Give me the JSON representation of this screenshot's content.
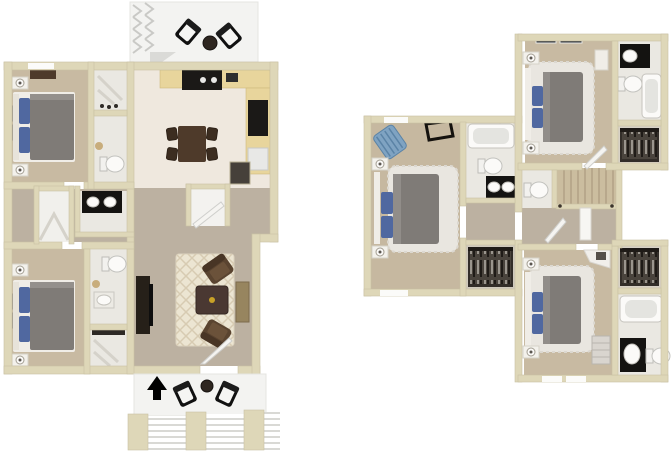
{
  "scene": {
    "background": "#ffffff",
    "type": "3d-floorplan-rendering",
    "plan_count": 2
  },
  "palette": {
    "wall": "#ded7b8",
    "wall_edge": "#c8c1a2",
    "tile": "#eae8e2",
    "tile_warm": "#efe8de",
    "carpet": "#c8baa2",
    "carpet_hall": "#bcb1a1",
    "carpet_master": "#c6b8a0",
    "fluffy": "#e9e6e0",
    "rug": "#ece5d2",
    "rug_line": "#d7cbb2",
    "counter": "#e8d59c",
    "appliance": "#1b1917",
    "wood": "#4e3a2a",
    "wood_dark": "#3c2d20",
    "bed_gray": "#7f7b77",
    "pillow_blue": "#5068a0",
    "fixture": "#fbfaf8",
    "fixture_edge": "#c5c3bd",
    "vanity": "#141311",
    "shelf": "#332e29",
    "stairs": "#cbbd9f",
    "stair_line": "#b2a286",
    "concrete": "#f3f3f1",
    "chevron": "#c9c9c6",
    "navy": "#425070",
    "chair_brown": "#5a4430",
    "chair_blue": "#7fa3c2",
    "arrow": "#000000",
    "tan_accent": "#c8ad7c",
    "tv": "#0e0e0e",
    "console_tan": "#97855f"
  },
  "floorplans": [
    {
      "id": "first-floor",
      "position": "left",
      "rooms": [
        "patio-top",
        "bedroom-1",
        "closet-bath-1",
        "kitchen",
        "dining-area",
        "hallway",
        "hall-closet",
        "hall-bathroom",
        "laundry-closet",
        "bedroom-2",
        "bath-closet-2",
        "living-room",
        "entry",
        "patio-bottom",
        "front-steps"
      ],
      "furnishings": [
        "outdoor-chairs",
        "round-table",
        "beds-with-blue-pillows",
        "nightstands-with-lamps",
        "wall-art",
        "dresser",
        "range",
        "refrigerator",
        "dining-table-4-chairs",
        "trellis-rug",
        "ottoman",
        "armchairs",
        "tv-console",
        "toilets",
        "double-sink-vanity",
        "north-arrow"
      ]
    },
    {
      "id": "second-floor",
      "position": "right",
      "rooms": [
        "master-bedroom",
        "master-bathroom",
        "master-closet",
        "hall",
        "water-closet",
        "staircase",
        "bedroom-2",
        "bathroom-2",
        "closet-2",
        "bedroom-3",
        "bathroom-3",
        "closet-3"
      ],
      "furnishings": [
        "beds-on-shag-rugs",
        "blue-accent-chair",
        "skylight-frames",
        "bathtubs",
        "vanities-with-white-sinks",
        "toilets",
        "closet-shelving-with-clothes",
        "white-desk",
        "dressers"
      ]
    }
  ],
  "compass": {
    "symbol": "north-arrow",
    "direction": "up"
  }
}
